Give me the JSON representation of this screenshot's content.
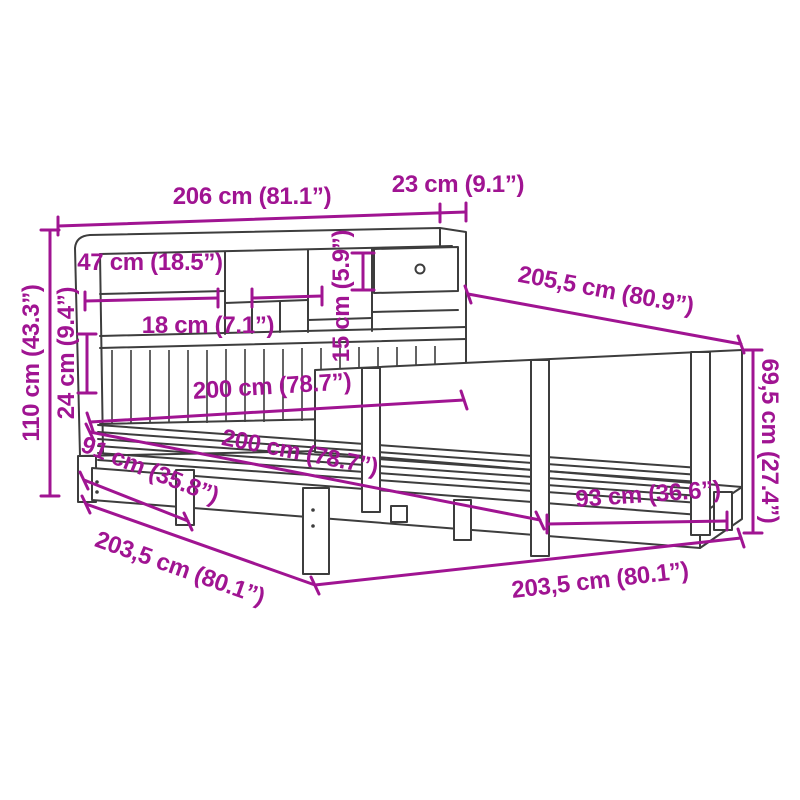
{
  "figure": {
    "title": "Bed with bookcase headboard — dimension diagram",
    "background": "#ffffff",
    "colors": {
      "dimension": "#a01492",
      "line_art": "#3d3d3d"
    },
    "units": "cm (inches)",
    "dims": [
      {
        "name": "headboard-width",
        "label": "206 cm (81.1”)"
      },
      {
        "name": "headboard-depth",
        "label": "23 cm (9.1”)"
      },
      {
        "name": "shelf-compartment-width",
        "label": "47 cm (18.5”)"
      },
      {
        "name": "small-compartment-width",
        "label": "18 cm (7.1”)"
      },
      {
        "name": "drawer-compartment-height",
        "label": "15 cm (5.9”)"
      },
      {
        "name": "overall-length",
        "label": "205,5 cm (80.9”)"
      },
      {
        "name": "headboard-height",
        "label": "110 cm (43.3”)"
      },
      {
        "name": "base-rail-height",
        "label": "24 cm (9.4”)"
      },
      {
        "name": "mattress-length-a",
        "label": "200 cm (78.7”)"
      },
      {
        "name": "mattress-length-b",
        "label": "200 cm (78.7”)"
      },
      {
        "name": "underbed-clearance-width",
        "label": "91 cm (35.8”)"
      },
      {
        "name": "frame-length-side",
        "label": "203,5 cm (80.1”)"
      },
      {
        "name": "frame-length-front",
        "label": "203,5 cm (80.1”)"
      },
      {
        "name": "post-spacing",
        "label": "93 cm (36.6”)"
      },
      {
        "name": "side-panel-height",
        "label": "69,5 cm (27.4”)"
      }
    ]
  }
}
